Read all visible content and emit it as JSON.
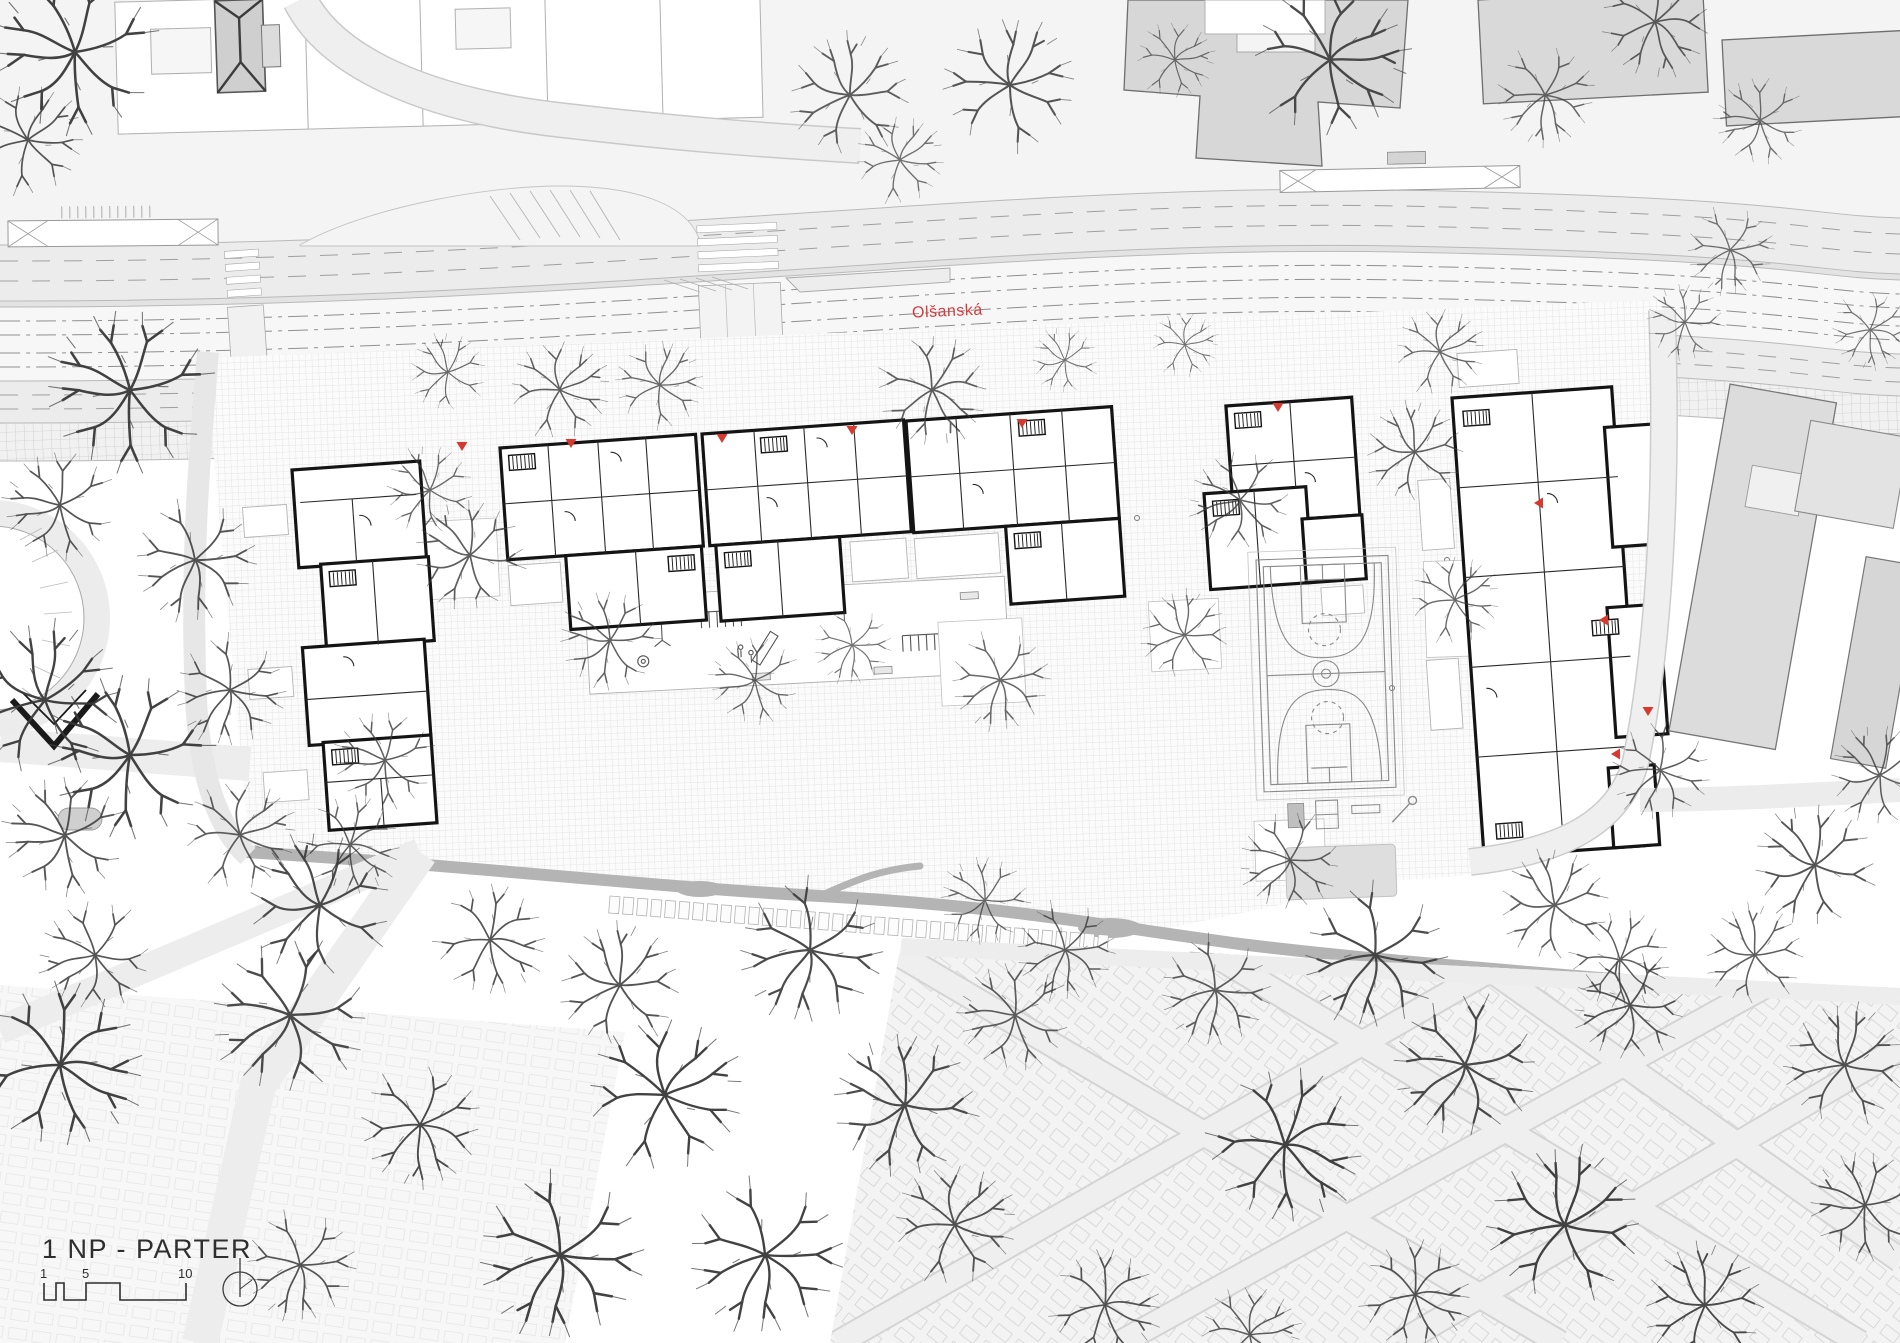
{
  "drawing": {
    "type": "architectural site plan / ground floor masterplan",
    "title": "1 NP - PARTER",
    "street_label": "Olšanská"
  },
  "title_block": {
    "title": "1 NP - PARTER",
    "scale_labels": [
      "1",
      "5",
      "10"
    ],
    "north_arrow": "north-arrow"
  },
  "street": {
    "name": "Olšanská",
    "label_color": "#d63a3a"
  },
  "colors": {
    "accent_red": "#d6392f",
    "building_wall": "#141414",
    "existing_building_gray": "#d9d9d9",
    "road_gray": "#ececec",
    "tram_band": "#f7f7f7",
    "paving_line": "#bdbdbd",
    "wall_shadow": "#b4b4b4",
    "tree_ink": "#383838"
  },
  "entrance_markers": [
    {
      "x": 462,
      "y": 449,
      "rot": 0
    },
    {
      "x": 571,
      "y": 446,
      "rot": 0
    },
    {
      "x": 722,
      "y": 441,
      "rot": 0
    },
    {
      "x": 852,
      "y": 433,
      "rot": 0
    },
    {
      "x": 1022,
      "y": 426,
      "rot": 0
    },
    {
      "x": 1278,
      "y": 410,
      "rot": 0
    },
    {
      "x": 1536,
      "y": 503,
      "rot": 90
    },
    {
      "x": 1601,
      "y": 620,
      "rot": 90
    },
    {
      "x": 1648,
      "y": 714,
      "rot": 0
    },
    {
      "x": 1613,
      "y": 754,
      "rot": 90
    }
  ],
  "trees": [
    [
      75,
      52,
      1.5,
      0.95
    ],
    [
      28,
      140,
      1.0,
      0.85
    ],
    [
      850,
      95,
      1.1,
      0.8
    ],
    [
      900,
      160,
      0.8,
      0.7
    ],
    [
      1010,
      85,
      1.2,
      0.85
    ],
    [
      1175,
      60,
      0.7,
      0.7
    ],
    [
      1330,
      60,
      1.4,
      0.9
    ],
    [
      1545,
      95,
      0.9,
      0.75
    ],
    [
      1655,
      22,
      1.0,
      0.8
    ],
    [
      1760,
      120,
      0.8,
      0.7
    ],
    [
      448,
      372,
      0.7,
      0.75
    ],
    [
      1065,
      360,
      0.6,
      0.7
    ],
    [
      1185,
      345,
      0.6,
      0.7
    ],
    [
      1440,
      352,
      0.8,
      0.75
    ],
    [
      1685,
      322,
      0.7,
      0.7
    ],
    [
      560,
      390,
      0.9,
      0.8
    ],
    [
      660,
      385,
      0.8,
      0.75
    ],
    [
      932,
      390,
      1.0,
      0.8
    ],
    [
      470,
      555,
      1.0,
      0.8
    ],
    [
      610,
      640,
      0.9,
      0.8
    ],
    [
      755,
      680,
      0.8,
      0.75
    ],
    [
      852,
      645,
      0.7,
      0.7
    ],
    [
      1000,
      680,
      0.9,
      0.75
    ],
    [
      1185,
      635,
      0.8,
      0.75
    ],
    [
      1240,
      500,
      0.9,
      0.8
    ],
    [
      1415,
      452,
      0.9,
      0.8
    ],
    [
      1290,
      860,
      0.9,
      0.8
    ],
    [
      1455,
      600,
      0.8,
      0.75
    ],
    [
      1555,
      905,
      1.0,
      0.8
    ],
    [
      1620,
      960,
      0.9,
      0.8
    ],
    [
      130,
      390,
      1.5,
      0.95
    ],
    [
      60,
      505,
      1.0,
      0.85
    ],
    [
      195,
      560,
      1.1,
      0.85
    ],
    [
      45,
      700,
      1.4,
      0.95
    ],
    [
      230,
      690,
      1.0,
      0.85
    ],
    [
      130,
      755,
      1.5,
      0.95
    ],
    [
      65,
      835,
      1.1,
      0.85
    ],
    [
      240,
      835,
      1.0,
      0.8
    ],
    [
      320,
      905,
      1.3,
      0.9
    ],
    [
      95,
      955,
      1.0,
      0.85
    ],
    [
      385,
      760,
      0.9,
      0.8
    ],
    [
      350,
      845,
      0.9,
      0.8
    ],
    [
      430,
      490,
      0.8,
      0.75
    ],
    [
      60,
      1065,
      1.5,
      0.95
    ],
    [
      290,
      1015,
      1.4,
      0.9
    ],
    [
      490,
      940,
      1.0,
      0.85
    ],
    [
      620,
      985,
      1.1,
      0.85
    ],
    [
      420,
      1125,
      1.1,
      0.9
    ],
    [
      665,
      1095,
      1.4,
      0.95
    ],
    [
      810,
      950,
      1.3,
      0.9
    ],
    [
      560,
      1255,
      1.5,
      0.95
    ],
    [
      300,
      1265,
      1.0,
      0.85
    ],
    [
      765,
      1255,
      1.4,
      0.95
    ],
    [
      905,
      1105,
      1.3,
      0.9
    ],
    [
      1015,
      1015,
      1.0,
      0.8
    ],
    [
      955,
      1225,
      1.1,
      0.85
    ],
    [
      1105,
      1305,
      1.0,
      0.85
    ],
    [
      1065,
      950,
      0.9,
      0.8
    ],
    [
      1215,
      990,
      1.0,
      0.8
    ],
    [
      1375,
      955,
      1.3,
      0.9
    ],
    [
      1285,
      1145,
      1.4,
      0.95
    ],
    [
      1465,
      1065,
      1.3,
      0.9
    ],
    [
      1630,
      1005,
      1.0,
      0.85
    ],
    [
      1755,
      955,
      0.9,
      0.8
    ],
    [
      1845,
      1065,
      1.1,
      0.85
    ],
    [
      1565,
      1225,
      1.4,
      0.95
    ],
    [
      1705,
      1305,
      1.1,
      0.9
    ],
    [
      1415,
      1295,
      1.0,
      0.85
    ],
    [
      1865,
      1205,
      1.0,
      0.85
    ],
    [
      1250,
      1335,
      0.9,
      0.8
    ],
    [
      1815,
      865,
      1.1,
      0.85
    ],
    [
      1880,
      775,
      0.9,
      0.8
    ],
    [
      1660,
      770,
      0.9,
      0.8
    ],
    [
      985,
      900,
      0.8,
      0.75
    ],
    [
      1730,
      250,
      0.8,
      0.7
    ],
    [
      1870,
      330,
      0.7,
      0.7
    ]
  ]
}
